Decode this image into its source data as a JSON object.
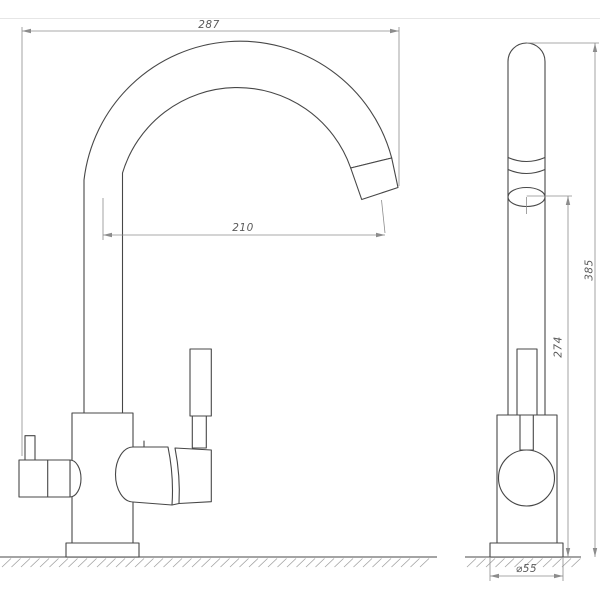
{
  "drawing": {
    "dimensions": {
      "overall_width_mm": "287",
      "spout_reach_mm": "210",
      "overall_height_mm": "385",
      "spout_height_mm": "274",
      "base_diameter_mm": "⌀55"
    },
    "colors": {
      "background": "#ffffff",
      "object_line": "#474747",
      "dimension_line": "#8c8c8c",
      "dimension_text": "#5a5a5a",
      "ground_line": "#6e6e6e",
      "hatch_line": "#a2a2a2",
      "frame_line": "#e6e6e6"
    }
  }
}
